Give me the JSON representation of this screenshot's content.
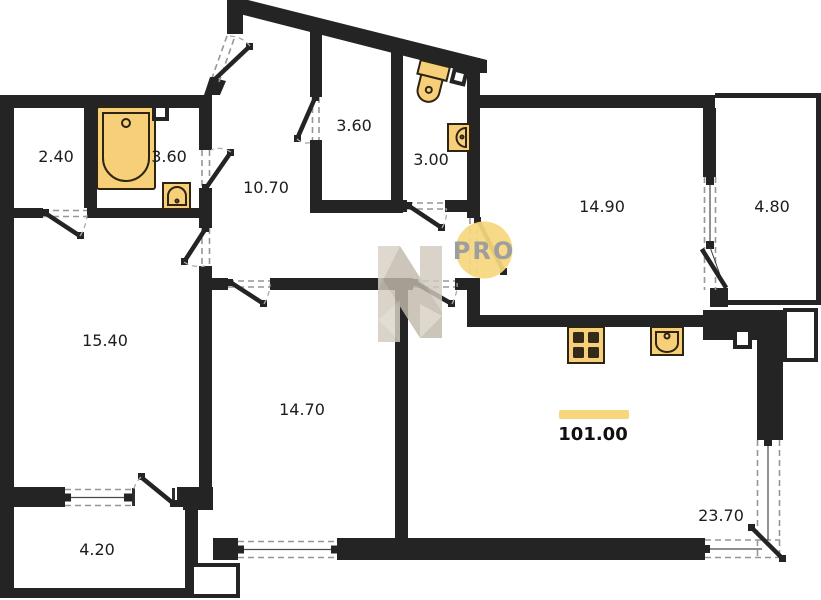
{
  "plan": {
    "title": "apartment-floor-plan",
    "total_area": {
      "value": "101.00"
    },
    "watermark": {
      "badge": "PRO",
      "logo": "n-house-logo"
    },
    "rooms": [
      {
        "id": "closet-top-left",
        "area": "2.40"
      },
      {
        "id": "bathroom",
        "area": "3.60"
      },
      {
        "id": "hallway",
        "area": "10.70"
      },
      {
        "id": "wardrobe-top",
        "area": "3.60"
      },
      {
        "id": "wc",
        "area": "3.00"
      },
      {
        "id": "bedroom-right",
        "area": "14.90"
      },
      {
        "id": "balcony-right",
        "area": "4.80"
      },
      {
        "id": "bedroom-left",
        "area": "15.40"
      },
      {
        "id": "bedroom-bottom",
        "area": "14.70"
      },
      {
        "id": "living-kitchen",
        "area": "23.70"
      },
      {
        "id": "balcony-bottom-left",
        "area": "4.20"
      }
    ],
    "fixtures": [
      "bathtub",
      "bathroom-sink",
      "toilet",
      "wc-sink",
      "stove",
      "kitchen-sink"
    ],
    "colors": {
      "wall": "#242424",
      "dash": "#969696",
      "label": "#1c1c1c",
      "accent": "#f6d77e",
      "fixture_fill": "#f7cf79",
      "fixture_stroke": "#2d2414",
      "burner": "#332a18",
      "wm_beige": "#d2cabe",
      "wm_text": "#9e9e9e"
    }
  }
}
